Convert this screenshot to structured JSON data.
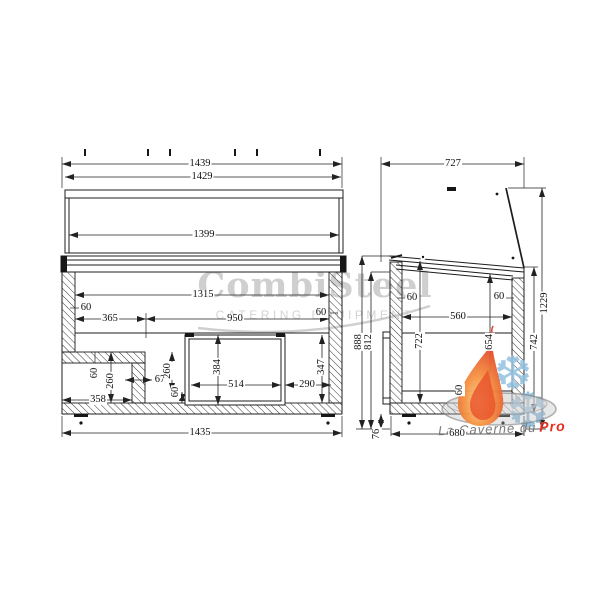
{
  "watermark": {
    "brand": "CombiSteel",
    "tagline": "CATERING EQUIPMENT"
  },
  "logo": {
    "text": "La Caverne du",
    "accent": "Pro",
    "snowflake_char": "❆"
  },
  "colors": {
    "line": "#1c1c1c",
    "watermark": "#c7c7c7",
    "flame_outer": "#e2482a",
    "flame_inner": "#fcd08a",
    "snowflake": "#93c1e0",
    "logo_text": "#7a7a7a",
    "logo_accent": "#e2301f"
  },
  "front_view": {
    "dims": {
      "width_top": "1439",
      "width_body_top": "1429",
      "glass_width": "1399",
      "inner_width": "1315",
      "wall_left": "60",
      "wall_right": "60",
      "offset_left": "365",
      "opening_width": "950",
      "recess_panel": "60",
      "recess_height": "260",
      "recess_width": "358",
      "step_gap": "67",
      "mid_height": "260",
      "mid_base": "60",
      "vent_height": "384",
      "vent_width": "514",
      "vent_right_gap": "290",
      "right_inner_height": "347",
      "base_width": "1435"
    }
  },
  "side_view": {
    "dims": {
      "depth_total": "727",
      "wall_front": "60",
      "wall_back": "60",
      "inner_depth": "560",
      "inner_height_front": "722",
      "inner_height_back": "654",
      "body_height_back": "742",
      "height_total": "1229",
      "height_front": "888",
      "height_front_inner": "812",
      "base_panel": "60",
      "caster_height": "76",
      "base_depth": "680"
    }
  }
}
